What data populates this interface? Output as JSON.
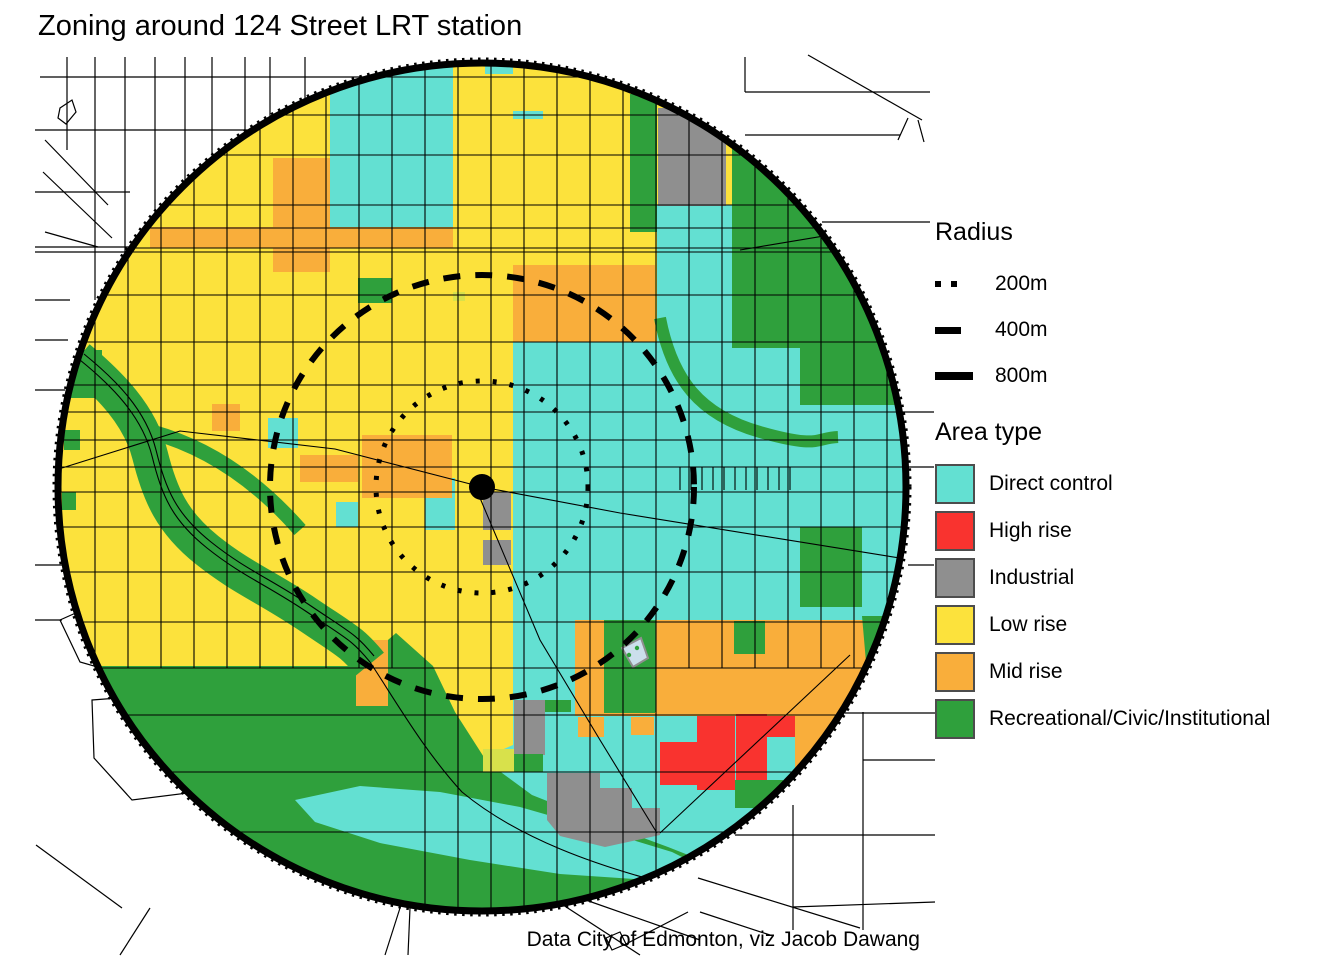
{
  "title": "Zoning around 124 Street LRT station",
  "caption": "Data City of Edmonton, viz Jacob Dawang",
  "legend_radius": {
    "title": "Radius",
    "items": [
      {
        "label": "200m",
        "style": "dotted"
      },
      {
        "label": "400m",
        "style": "dashed"
      },
      {
        "label": "800m",
        "style": "solid"
      }
    ]
  },
  "legend_area": {
    "title": "Area type",
    "items": [
      {
        "key": "direct_control",
        "label": "Direct control",
        "color": "#63E0D2"
      },
      {
        "key": "high_rise",
        "label": "High rise",
        "color": "#F9332F"
      },
      {
        "key": "industrial",
        "label": "Industrial",
        "color": "#8F8F8F"
      },
      {
        "key": "low_rise",
        "label": "Low rise",
        "color": "#FCE23C"
      },
      {
        "key": "mid_rise",
        "label": "Mid rise",
        "color": "#F9AE3B"
      },
      {
        "key": "recreational",
        "label": "Recreational/Civic/Institutional",
        "color": "#2FA03C"
      }
    ]
  },
  "map": {
    "rings": [
      {
        "name": "ring-200m",
        "radius_m": 200
      },
      {
        "name": "ring-400m",
        "radius_m": 400
      },
      {
        "name": "ring-800m",
        "radius_m": 800
      }
    ],
    "colors": {
      "background": "#FFFFFF",
      "street": "#000000",
      "ring": "#000000",
      "station_dot": "#000000",
      "lime_patch": "#D8E14B",
      "pool": "#CBDFEC",
      "swatch_border": "#4d4d4d"
    }
  }
}
